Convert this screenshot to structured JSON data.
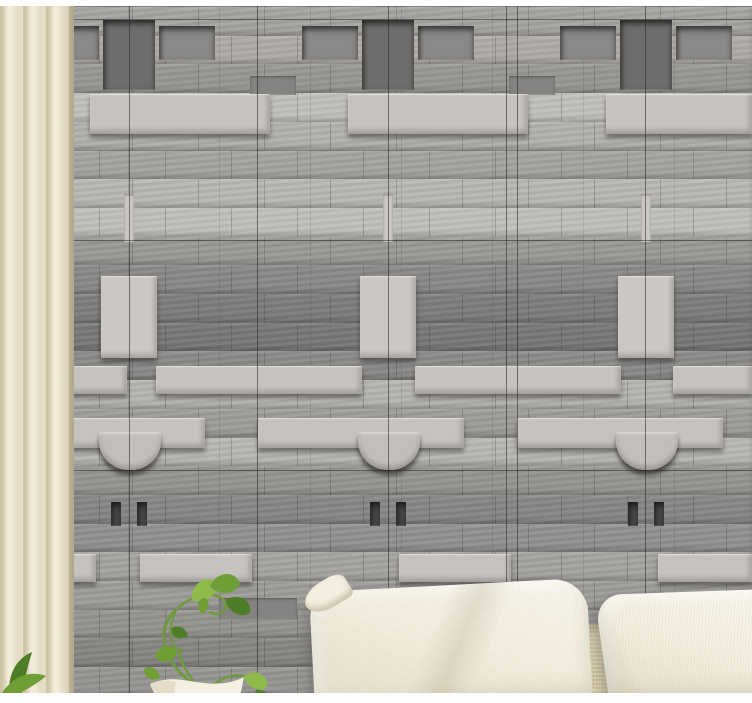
{
  "scene": {
    "palette": {
      "wall_base": "#a0a09e",
      "light_brick": "#c6c3bf",
      "light_block": "#cbc8c4",
      "dark_block": "#6f6d6b",
      "recess_panel": "#8b8987",
      "mid_dark_brick": "#858381",
      "notch_dark": "#4c4a48",
      "bowl_block": "#c2bfbb",
      "slit_light": "#cbc8c4",
      "seam": "rgba(38,36,34,0.55)",
      "curtain_light": "#f1ebd8",
      "curtain_mid": "#e4dcc4",
      "curtain_shade": "#cdc3a5",
      "pillow_light": "#f3eede",
      "backrest": "#d5caaa",
      "pot_light": "#f4efe0",
      "pot_shade": "#d8cfb4",
      "stem": "#6d9a3a",
      "leaf_light": "#8fba4c",
      "leaf_mid": "#6f9e36",
      "leaf_dark": "#4e7d28",
      "frame_top": "#ffffff",
      "frame_bottom": "#fdfdfd"
    },
    "wall": {
      "top": 6,
      "row_height": 28.7,
      "rows": [
        "#a19f9c",
        "#aaa7a4",
        "#94928f",
        "#c1bfbb",
        "#b2b0ad",
        "#a4a29f",
        "#b9b7b3",
        "#c3c1bd",
        "#9b9996",
        "#8a8886",
        "#7e7c7a",
        "#7a7876",
        "#8d8b89",
        "#bcbab6",
        "#a3a19e",
        "#c0beba",
        "#9c9a97",
        "#8d8b89",
        "#999795",
        "#aeaca9",
        "#a7a5a2",
        "#9e9c99",
        "#908e8b",
        "#a19f9c"
      ],
      "seams": {
        "vertical": [
          129,
          257,
          388,
          506,
          517,
          645
        ],
        "horizontal": [
          19,
          240,
          470
        ]
      },
      "motifs": [
        {
          "x": 103,
          "y": 20,
          "w": 52,
          "h": 70,
          "c": "dark_block",
          "style": "recessed"
        },
        {
          "x": 362,
          "y": 20,
          "w": 52,
          "h": 70,
          "c": "dark_block",
          "style": "recessed"
        },
        {
          "x": 620,
          "y": 20,
          "w": 52,
          "h": 70,
          "c": "dark_block",
          "style": "recessed"
        },
        {
          "x": 43,
          "y": 26,
          "w": 56,
          "h": 34,
          "c": "recess_panel",
          "style": "recessed"
        },
        {
          "x": 159,
          "y": 26,
          "w": 56,
          "h": 34,
          "c": "recess_panel",
          "style": "recessed"
        },
        {
          "x": 302,
          "y": 26,
          "w": 56,
          "h": 34,
          "c": "recess_panel",
          "style": "recessed"
        },
        {
          "x": 418,
          "y": 26,
          "w": 56,
          "h": 34,
          "c": "recess_panel",
          "style": "recessed"
        },
        {
          "x": 560,
          "y": 26,
          "w": 56,
          "h": 34,
          "c": "recess_panel",
          "style": "recessed"
        },
        {
          "x": 676,
          "y": 26,
          "w": 56,
          "h": 34,
          "c": "recess_panel",
          "style": "recessed"
        },
        {
          "x": 0,
          "y": 76,
          "w": 38,
          "h": 19,
          "c": "mid_dark_brick",
          "style": "flat"
        },
        {
          "x": 250,
          "y": 76,
          "w": 46,
          "h": 19,
          "c": "mid_dark_brick",
          "style": "flat"
        },
        {
          "x": 509,
          "y": 76,
          "w": 46,
          "h": 19,
          "c": "mid_dark_brick",
          "style": "flat"
        },
        {
          "x": 0,
          "y": 94,
          "w": 50,
          "h": 40,
          "c": "light_brick",
          "style": "raised"
        },
        {
          "x": 90,
          "y": 94,
          "w": 180,
          "h": 40,
          "c": "light_brick",
          "style": "raised"
        },
        {
          "x": 348,
          "y": 94,
          "w": 180,
          "h": 40,
          "c": "light_brick",
          "style": "raised"
        },
        {
          "x": 606,
          "y": 94,
          "w": 146,
          "h": 40,
          "c": "light_brick",
          "style": "raised"
        },
        {
          "x": 124,
          "y": 194,
          "w": 10,
          "h": 48,
          "c": "slit_light",
          "style": "flat"
        },
        {
          "x": 383,
          "y": 194,
          "w": 10,
          "h": 48,
          "c": "slit_light",
          "style": "flat"
        },
        {
          "x": 641,
          "y": 194,
          "w": 10,
          "h": 48,
          "c": "slit_light",
          "style": "flat"
        },
        {
          "x": 101,
          "y": 276,
          "w": 56,
          "h": 82,
          "c": "light_block",
          "style": "raised"
        },
        {
          "x": 360,
          "y": 276,
          "w": 56,
          "h": 82,
          "c": "light_block",
          "style": "raised"
        },
        {
          "x": 618,
          "y": 276,
          "w": 56,
          "h": 82,
          "c": "light_block",
          "style": "raised"
        },
        {
          "x": 25,
          "y": 366,
          "w": 102,
          "h": 28,
          "c": "light_brick",
          "style": "raised"
        },
        {
          "x": 156,
          "y": 366,
          "w": 206,
          "h": 28,
          "c": "light_brick",
          "style": "raised"
        },
        {
          "x": 415,
          "y": 366,
          "w": 206,
          "h": 28,
          "c": "light_brick",
          "style": "raised"
        },
        {
          "x": 673,
          "y": 366,
          "w": 79,
          "h": 28,
          "c": "light_brick",
          "style": "raised"
        },
        {
          "x": 0,
          "y": 418,
          "w": 205,
          "h": 30,
          "c": "light_brick",
          "style": "raised"
        },
        {
          "x": 258,
          "y": 418,
          "w": 206,
          "h": 30,
          "c": "light_brick",
          "style": "raised"
        },
        {
          "x": 517,
          "y": 418,
          "w": 206,
          "h": 30,
          "c": "light_brick",
          "style": "raised"
        },
        {
          "x": 99,
          "y": 432,
          "w": 62,
          "h": 38,
          "c": "bowl_block",
          "style": "bowl"
        },
        {
          "x": 358,
          "y": 432,
          "w": 62,
          "h": 38,
          "c": "bowl_block",
          "style": "bowl"
        },
        {
          "x": 616,
          "y": 432,
          "w": 62,
          "h": 38,
          "c": "bowl_block",
          "style": "bowl"
        },
        {
          "x": 111,
          "y": 502,
          "w": 10,
          "h": 24,
          "c": "notch_dark",
          "style": "recessed"
        },
        {
          "x": 137,
          "y": 502,
          "w": 10,
          "h": 24,
          "c": "notch_dark",
          "style": "recessed"
        },
        {
          "x": 370,
          "y": 502,
          "w": 10,
          "h": 24,
          "c": "notch_dark",
          "style": "recessed"
        },
        {
          "x": 396,
          "y": 502,
          "w": 10,
          "h": 24,
          "c": "notch_dark",
          "style": "recessed"
        },
        {
          "x": 628,
          "y": 502,
          "w": 10,
          "h": 24,
          "c": "notch_dark",
          "style": "recessed"
        },
        {
          "x": 654,
          "y": 502,
          "w": 10,
          "h": 24,
          "c": "notch_dark",
          "style": "recessed"
        },
        {
          "x": 0,
          "y": 554,
          "w": 96,
          "h": 28,
          "c": "light_brick",
          "style": "raised"
        },
        {
          "x": 140,
          "y": 554,
          "w": 112,
          "h": 28,
          "c": "light_brick",
          "style": "raised"
        },
        {
          "x": 399,
          "y": 554,
          "w": 112,
          "h": 28,
          "c": "light_brick",
          "style": "raised"
        },
        {
          "x": 658,
          "y": 554,
          "w": 94,
          "h": 28,
          "c": "light_brick",
          "style": "raised"
        },
        {
          "x": 0,
          "y": 598,
          "w": 60,
          "h": 22,
          "c": "mid_dark_brick",
          "style": "flat"
        },
        {
          "x": 219,
          "y": 598,
          "w": 78,
          "h": 22,
          "c": "mid_dark_brick",
          "style": "flat"
        },
        {
          "x": 478,
          "y": 598,
          "w": 78,
          "h": 22,
          "c": "mid_dark_brick",
          "style": "flat"
        }
      ]
    }
  }
}
